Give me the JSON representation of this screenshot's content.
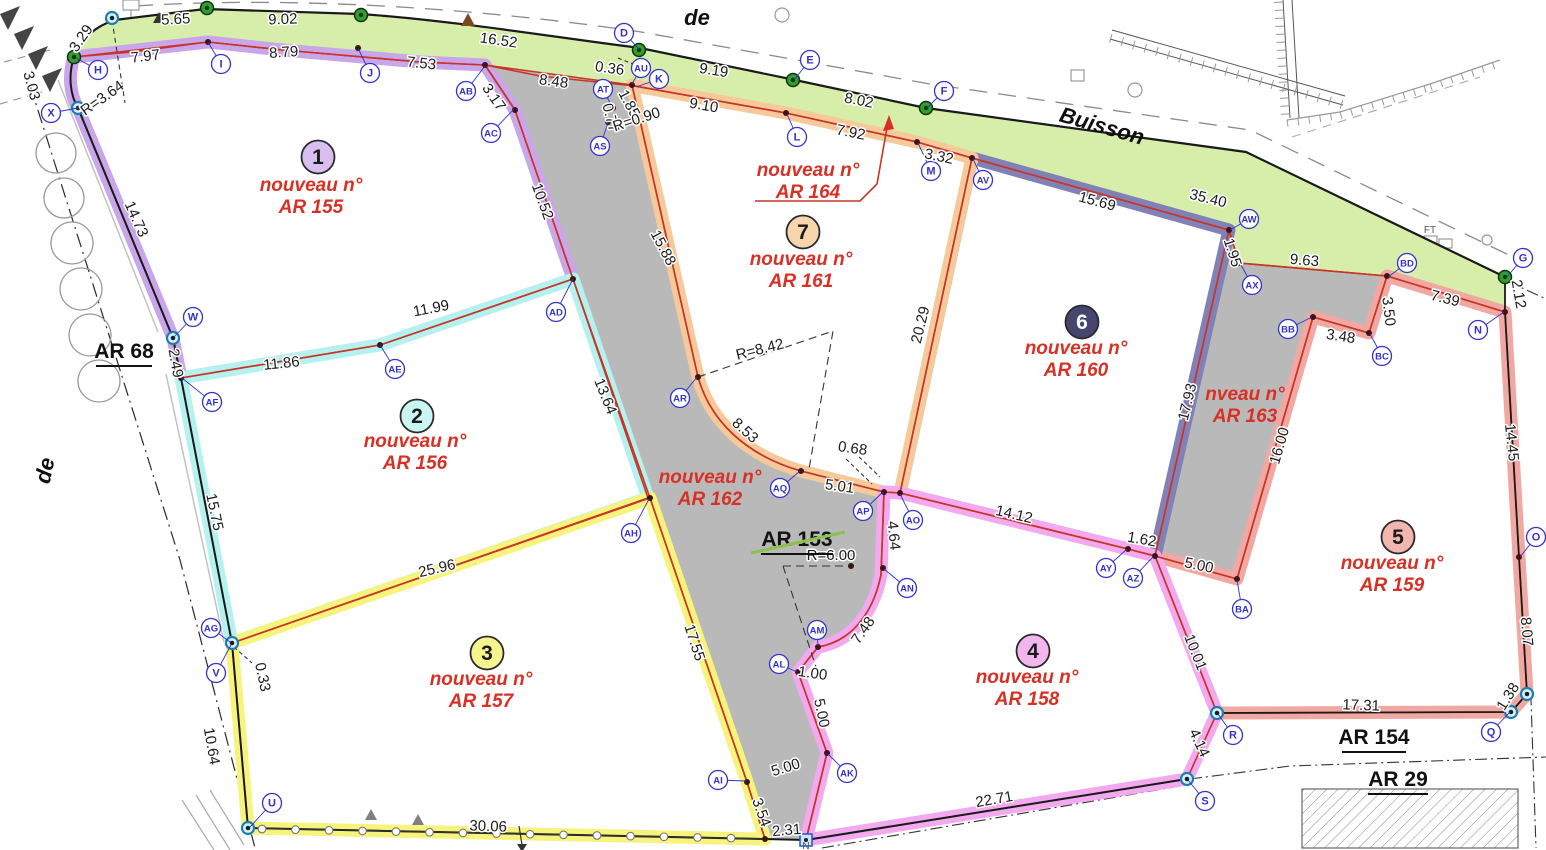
{
  "plan": {
    "type": "cadastral-division-plan",
    "old_parcel_struck": "AR 153",
    "new_parcel_numbers": [
      "AR 155",
      "AR 156",
      "AR 157",
      "AR 158",
      "AR 159",
      "AR 160",
      "AR 161",
      "AR 162",
      "AR 163",
      "AR 164"
    ]
  },
  "colors": {
    "paper": "#ffffff",
    "green_strip": "#d7eeab",
    "road_gray": "#b9b9b9",
    "red_line": "#c73527",
    "black_line": "#1a1a1a",
    "red_text": "#d93025",
    "blue_label": "#3232cc",
    "dot": "#3c1414",
    "green_marker": "#2f9e2f",
    "teal_marker": "#1d7fae",
    "strike_green": "#8bc34a",
    "decor_gray": "#999999"
  },
  "streets": [
    {
      "text": "de",
      "x": 697,
      "y": 25,
      "rotate": 0
    },
    {
      "text": "Buisson",
      "x": 1100,
      "y": 133,
      "rotate": 16
    },
    {
      "text": "de",
      "x": 52,
      "y": 472,
      "rotate": -78
    }
  ],
  "area_labels": [
    {
      "text": "AR 68",
      "x": 124,
      "y": 358,
      "underline": [
        96,
        366,
        152,
        366
      ]
    },
    {
      "text": "AR 153",
      "x": 797,
      "y": 546,
      "underline": [
        761,
        554,
        833,
        554
      ],
      "strike": [
        751,
        553,
        845,
        532
      ]
    },
    {
      "text": "AR 154",
      "x": 1374,
      "y": 744,
      "underline": [
        1342,
        752,
        1406,
        752
      ]
    },
    {
      "text": "AR 29",
      "x": 1398,
      "y": 786,
      "underline": [
        1368,
        794,
        1428,
        794
      ]
    }
  ],
  "lots": [
    {
      "num": "1",
      "line1": "nouveau n°",
      "line2": "AR 155",
      "band": "#c9a6e9",
      "badge": "#d9bff1",
      "badge_text": "#1a1a1a",
      "badge_x": 318,
      "badge_y": 157,
      "text_x": 311,
      "text_y": 191
    },
    {
      "num": "2",
      "line1": "nouveau n°",
      "line2": "AR 156",
      "band": "#b5f1ef",
      "badge": "#c9f6f3",
      "badge_text": "#1a1a1a",
      "badge_x": 417,
      "badge_y": 416,
      "text_x": 415,
      "text_y": 447
    },
    {
      "num": "3",
      "line1": "nouveau n°",
      "line2": "AR 157",
      "band": "#f6f47c",
      "badge": "#f6f48c",
      "badge_text": "#1a1a1a",
      "badge_x": 487,
      "badge_y": 653,
      "text_x": 481,
      "text_y": 685
    },
    {
      "num": "4",
      "line1": "nouveau n°",
      "line2": "AR 158",
      "band": "#f2a9ef",
      "badge": "#f2b6ef",
      "badge_text": "#1a1a1a",
      "badge_x": 1033,
      "badge_y": 651,
      "text_x": 1027,
      "text_y": 683
    },
    {
      "num": "5",
      "line1": "nouveau n°",
      "line2": "AR 159",
      "band": "#f1a8a2",
      "badge": "#f2b5af",
      "badge_text": "#1a1a1a",
      "badge_x": 1398,
      "badge_y": 537,
      "text_x": 1392,
      "text_y": 569
    },
    {
      "num": "6",
      "line1": "nouveau n°",
      "line2": "AR 160",
      "band": "#8181b6",
      "badge": "#45456e",
      "badge_text": "#ffffff",
      "badge_x": 1082,
      "badge_y": 322,
      "text_x": 1076,
      "text_y": 354
    },
    {
      "num": "7",
      "line1": "nouveau n°",
      "line2": "AR 161",
      "band": "#f6c99b",
      "badge": "#f7d6ad",
      "badge_text": "#1a1a1a",
      "badge_x": 803,
      "badge_y": 232,
      "text_x": 801,
      "text_y": 265
    }
  ],
  "road_labels": [
    {
      "line1": "nouveau n°",
      "line2": "AR 162",
      "x": 710,
      "y": 483
    },
    {
      "line1": "nveau n°",
      "line2": "AR 163",
      "x": 1245,
      "y": 400
    },
    {
      "line1": "nouveau n°",
      "line2": "AR 164",
      "x": 808,
      "y": 176
    }
  ],
  "misc_labels": [
    {
      "text": "FT",
      "x": 1430,
      "y": 233
    },
    {
      "text": "N",
      "x": 806,
      "y": 849
    }
  ],
  "measurements": [
    [
      "5.65",
      176,
      24,
      -3
    ],
    [
      "9.02",
      283,
      24,
      -2
    ],
    [
      "16.52",
      498,
      45,
      8
    ],
    [
      "0.36",
      609,
      73,
      8
    ],
    [
      "9.19",
      713,
      75,
      9
    ],
    [
      "8.02",
      858,
      105,
      11
    ],
    [
      "35.40",
      1207,
      203,
      14
    ],
    [
      "3.29",
      85,
      41,
      -55
    ],
    [
      "7.97",
      146,
      61,
      -7
    ],
    [
      "8.79",
      284,
      57,
      -4
    ],
    [
      "7.53",
      421,
      68,
      6
    ],
    [
      "3.03",
      27,
      87,
      75
    ],
    [
      "R=3.64",
      105,
      102,
      -35
    ],
    [
      "14.73",
      132,
      221,
      66
    ],
    [
      "3.17",
      490,
      100,
      55
    ],
    [
      "8.48",
      553,
      86,
      8
    ],
    [
      "1.85",
      625,
      106,
      62
    ],
    [
      "0.77",
      606,
      119,
      75
    ],
    [
      "R=0.90",
      638,
      124,
      -18
    ],
    [
      "9.10",
      703,
      110,
      10
    ],
    [
      "7.92",
      850,
      137,
      11
    ],
    [
      "3.32",
      938,
      161,
      12
    ],
    [
      "10.52",
      538,
      203,
      70
    ],
    [
      "15.88",
      659,
      250,
      62
    ],
    [
      "15.69",
      1096,
      206,
      15
    ],
    [
      "1.95",
      1228,
      254,
      72
    ],
    [
      "9.63",
      1304,
      265,
      5
    ],
    [
      "3.50",
      1384,
      312,
      83
    ],
    [
      "3.48",
      1340,
      341,
      9
    ],
    [
      "7.39",
      1444,
      303,
      14
    ],
    [
      "2.12",
      1514,
      295,
      80
    ],
    [
      "14.45",
      1507,
      443,
      84
    ],
    [
      "16.00",
      1284,
      447,
      -74
    ],
    [
      "17.93",
      1192,
      403,
      -76
    ],
    [
      "20.29",
      925,
      326,
      -76
    ],
    [
      "14.12",
      1013,
      519,
      13
    ],
    [
      "1.62",
      1141,
      544,
      10
    ],
    [
      "5.00",
      1198,
      570,
      12
    ],
    [
      "10.01",
      1191,
      654,
      68
    ],
    [
      "4.14",
      1195,
      745,
      65
    ],
    [
      "17.31",
      1361,
      710,
      2
    ],
    [
      "1.38",
      1512,
      699,
      -58
    ],
    [
      "8.07",
      1522,
      632,
      85
    ],
    [
      "11.99",
      432,
      313,
      -11
    ],
    [
      "11.86",
      282,
      368,
      -6
    ],
    [
      "2.49",
      171,
      364,
      80
    ],
    [
      "15.75",
      210,
      513,
      78
    ],
    [
      "13.64",
      601,
      398,
      68
    ],
    [
      "R=8.42",
      761,
      354,
      -14
    ],
    [
      "8.53",
      742,
      434,
      42
    ],
    [
      "5.01",
      839,
      491,
      8
    ],
    [
      "0.68",
      852,
      453,
      8
    ],
    [
      "4.64",
      889,
      536,
      84
    ],
    [
      "R=6.00",
      831,
      560,
      0
    ],
    [
      "7.48",
      867,
      633,
      -55
    ],
    [
      "1.00",
      812,
      678,
      8
    ],
    [
      "5.00",
      817,
      714,
      78
    ],
    [
      "5.00",
      787,
      772,
      -17
    ],
    [
      "3.54",
      757,
      814,
      70
    ],
    [
      "2.31",
      787,
      835,
      -5
    ],
    [
      "22.71",
      995,
      804,
      -10
    ],
    [
      "25.96",
      438,
      573,
      -13
    ],
    [
      "0.33",
      258,
      678,
      78
    ],
    [
      "10.64",
      207,
      747,
      80
    ],
    [
      "30.06",
      488,
      831,
      2
    ],
    [
      "17.55",
      690,
      644,
      72
    ]
  ],
  "points": [
    [
      "H",
      98,
      70,
      76,
      58
    ],
    [
      "X",
      51,
      113,
      78,
      108
    ],
    [
      "I",
      221,
      64,
      208,
      42
    ],
    [
      "J",
      370,
      73,
      358,
      48
    ],
    [
      "AB",
      466,
      91,
      485,
      66
    ],
    [
      "AC",
      491,
      133,
      514,
      109
    ],
    [
      "AD",
      556,
      312,
      573,
      279
    ],
    [
      "AE",
      395,
      369,
      380,
      345
    ],
    [
      "AF",
      212,
      402,
      182,
      378
    ],
    [
      "W",
      193,
      317,
      174,
      337
    ],
    [
      "AG",
      211,
      628,
      230,
      642
    ],
    [
      "V",
      216,
      673,
      231,
      645
    ],
    [
      "U",
      272,
      803,
      250,
      827
    ],
    [
      "AH",
      631,
      533,
      649,
      499
    ],
    [
      "AI",
      718,
      780,
      746,
      781
    ],
    [
      "AK",
      847,
      773,
      828,
      754
    ],
    [
      "AL",
      779,
      664,
      797,
      672
    ],
    [
      "AM",
      817,
      630,
      818,
      646
    ],
    [
      "AN",
      907,
      588,
      884,
      569
    ],
    [
      "AO",
      913,
      520,
      900,
      494
    ],
    [
      "AP",
      863,
      511,
      883,
      492
    ],
    [
      "AQ",
      780,
      488,
      800,
      471
    ],
    [
      "AR",
      680,
      398,
      697,
      377
    ],
    [
      "AS",
      600,
      146,
      608,
      123
    ],
    [
      "AT",
      603,
      89,
      612,
      107
    ],
    [
      "AU",
      641,
      68,
      632,
      84
    ],
    [
      "K",
      659,
      79,
      636,
      87
    ],
    [
      "D",
      624,
      33,
      639,
      49
    ],
    [
      "E",
      810,
      60,
      794,
      80
    ],
    [
      "L",
      797,
      137,
      787,
      114
    ],
    [
      "M",
      931,
      171,
      918,
      143
    ],
    [
      "F",
      944,
      91,
      927,
      108
    ],
    [
      "AV",
      983,
      180,
      973,
      159
    ],
    [
      "AW",
      1249,
      219,
      1230,
      230
    ],
    [
      "AX",
      1252,
      285,
      1240,
      263
    ],
    [
      "BB",
      1288,
      329,
      1312,
      317
    ],
    [
      "BC",
      1382,
      356,
      1370,
      334
    ],
    [
      "BD",
      1407,
      263,
      1388,
      277
    ],
    [
      "G",
      1523,
      258,
      1506,
      278
    ],
    [
      "N",
      1478,
      330,
      1504,
      312
    ],
    [
      "O",
      1536,
      537,
      1520,
      557
    ],
    [
      "Q",
      1491,
      732,
      1510,
      712
    ],
    [
      "R",
      1233,
      735,
      1218,
      714
    ],
    [
      "S",
      1205,
      801,
      1188,
      780
    ],
    [
      "BA",
      1242,
      609,
      1237,
      580
    ],
    [
      "AY",
      1106,
      568,
      1127,
      549
    ],
    [
      "AZ",
      1133,
      578,
      1154,
      556
    ]
  ],
  "markers": {
    "green": [
      [
        207,
        8
      ],
      [
        361,
        15
      ],
      [
        639,
        50
      ],
      [
        793,
        80
      ],
      [
        926,
        108
      ],
      [
        1505,
        277
      ],
      [
        74,
        57
      ]
    ],
    "teal": [
      [
        78,
        108
      ],
      [
        173,
        338
      ],
      [
        232,
        643
      ],
      [
        248,
        828
      ],
      [
        1217,
        713
      ],
      [
        1187,
        779
      ],
      [
        1511,
        712
      ],
      [
        1527,
        694
      ],
      [
        112,
        18
      ]
    ],
    "square": [
      [
        806,
        840
      ]
    ],
    "vertex_dots": [
      [
        208,
        42
      ],
      [
        358,
        48
      ],
      [
        485,
        65
      ],
      [
        515,
        110
      ],
      [
        573,
        279
      ],
      [
        380,
        345
      ],
      [
        181,
        378
      ],
      [
        650,
        498
      ],
      [
        747,
        782
      ],
      [
        827,
        753
      ],
      [
        798,
        672
      ],
      [
        818,
        647
      ],
      [
        883,
        568
      ],
      [
        884,
        492
      ],
      [
        900,
        493
      ],
      [
        801,
        471
      ],
      [
        698,
        377
      ],
      [
        613,
        108
      ],
      [
        608,
        122
      ],
      [
        632,
        85
      ],
      [
        786,
        113
      ],
      [
        917,
        142
      ],
      [
        972,
        158
      ],
      [
        1229,
        230
      ],
      [
        1239,
        263
      ],
      [
        1128,
        549
      ],
      [
        1155,
        556
      ],
      [
        1237,
        579
      ],
      [
        1313,
        317
      ],
      [
        1369,
        333
      ],
      [
        1387,
        276
      ],
      [
        1505,
        312
      ],
      [
        1519,
        557
      ],
      [
        851,
        566
      ],
      [
        765,
        839
      ]
    ]
  }
}
